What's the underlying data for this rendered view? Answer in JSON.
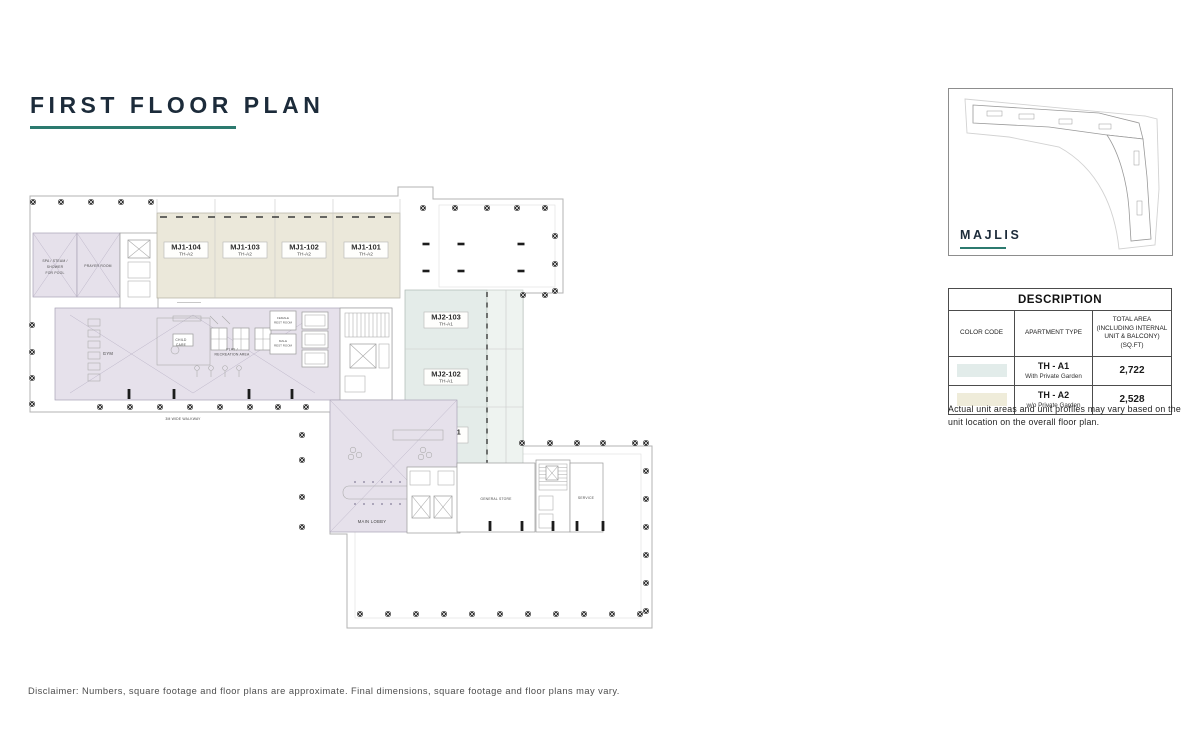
{
  "page": {
    "title": "FIRST FLOOR PLAN",
    "disclaimer": "Disclaimer: Numbers, square footage and floor plans are approximate. Final dimensions, square footage and floor plans may vary."
  },
  "key_plan": {
    "label": "MAJLIS"
  },
  "description_table": {
    "title": "DESCRIPTION",
    "columns": [
      "COLOR CODE",
      "APARTMENT TYPE",
      "TOTAL AREA (INCLUDING INTERNAL UNIT & BALCONY)(SQ.FT)"
    ],
    "rows": [
      {
        "color": "#e2ecea",
        "type": "TH - A1",
        "garden": "With Private Garden",
        "area": "2,722"
      },
      {
        "color": "#efecda",
        "type": "TH - A2",
        "garden": "w/o Private Garden",
        "area": "2,528"
      }
    ],
    "note": "Actual unit areas and unit profiles may vary based on the unit location on the overall floor plan."
  },
  "floor_plan": {
    "units": [
      {
        "id": "MJ1-104",
        "type": "TH-A2"
      },
      {
        "id": "MJ1-103",
        "type": "TH-A2"
      },
      {
        "id": "MJ1-102",
        "type": "TH-A2"
      },
      {
        "id": "MJ1-101",
        "type": "TH-A2"
      },
      {
        "id": "MJ2-103",
        "type": "TH-A1"
      },
      {
        "id": "MJ2-102",
        "type": "TH-A1"
      },
      {
        "id": "MJ2-101",
        "type": "TH-A1"
      }
    ],
    "rooms": {
      "spa1": "SPA / STEAM /",
      "spa2": "SHOWER",
      "spa3": "FOR POOL",
      "prayer": "PRAYER ROOM",
      "gym": "GYM",
      "child1": "CHILD",
      "child2": "CARE",
      "play1": "PLAY /",
      "play2": "RECREATION  AREA",
      "female1": "FEMALE",
      "female2": "REST ROOM",
      "male1": "MALE",
      "male2": "REST ROOM",
      "walkway": "3M WIDE WALKWAY",
      "lobby": "MAIN LOBBY",
      "store": "GENERAL STORE",
      "service": "SERVICE"
    }
  },
  "colors": {
    "accent_teal": "#2c7a6f",
    "title_navy": "#1c2b3a",
    "unit_th_a1": "#e4ece9",
    "unit_th_a2": "#ebe8da",
    "amenity_lavender": "#e6e1eb",
    "keyplan_highlight": "#f7e9e6"
  }
}
